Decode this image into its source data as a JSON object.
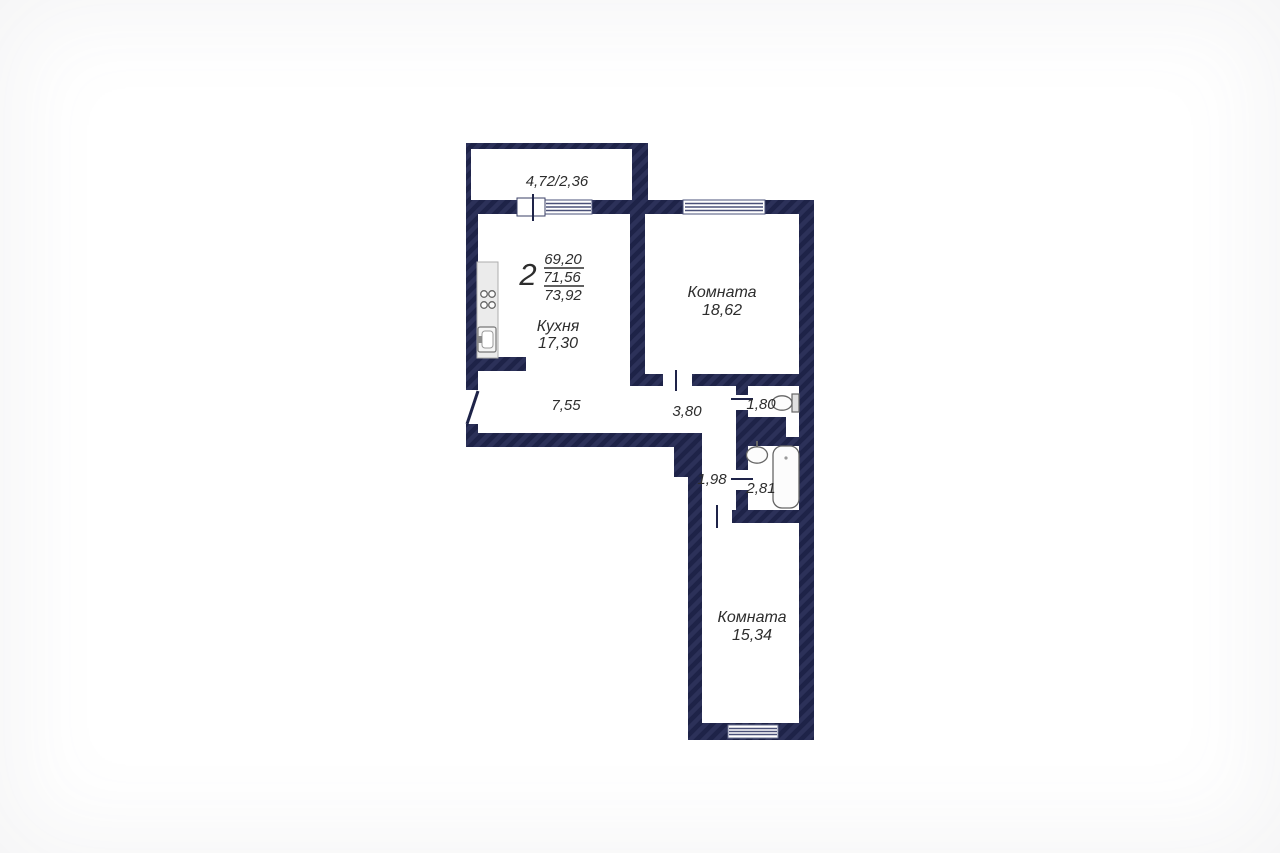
{
  "colors": {
    "wall": "#1e2348",
    "wall_stripe": "#2c3159",
    "text": "#2d2d2d",
    "fixture_stroke": "#666666",
    "background": "#ffffff"
  },
  "plan": {
    "apartment_rooms_count": "2",
    "area_total": "69,20",
    "area_second": "71,56",
    "area_third": "73,92",
    "balcony_dimensions": "4,72/2,36",
    "kitchen_name": "Кухня",
    "kitchen_area": "17,30",
    "room1_name": "Комната",
    "room1_area": "18,62",
    "room2_name": "Комната",
    "room2_area": "15,34",
    "hall_area": "7,55",
    "hallway_area": "3,80",
    "wc_area": "1,80",
    "corridor_area": "1,98",
    "bathroom_area": "2,81"
  }
}
